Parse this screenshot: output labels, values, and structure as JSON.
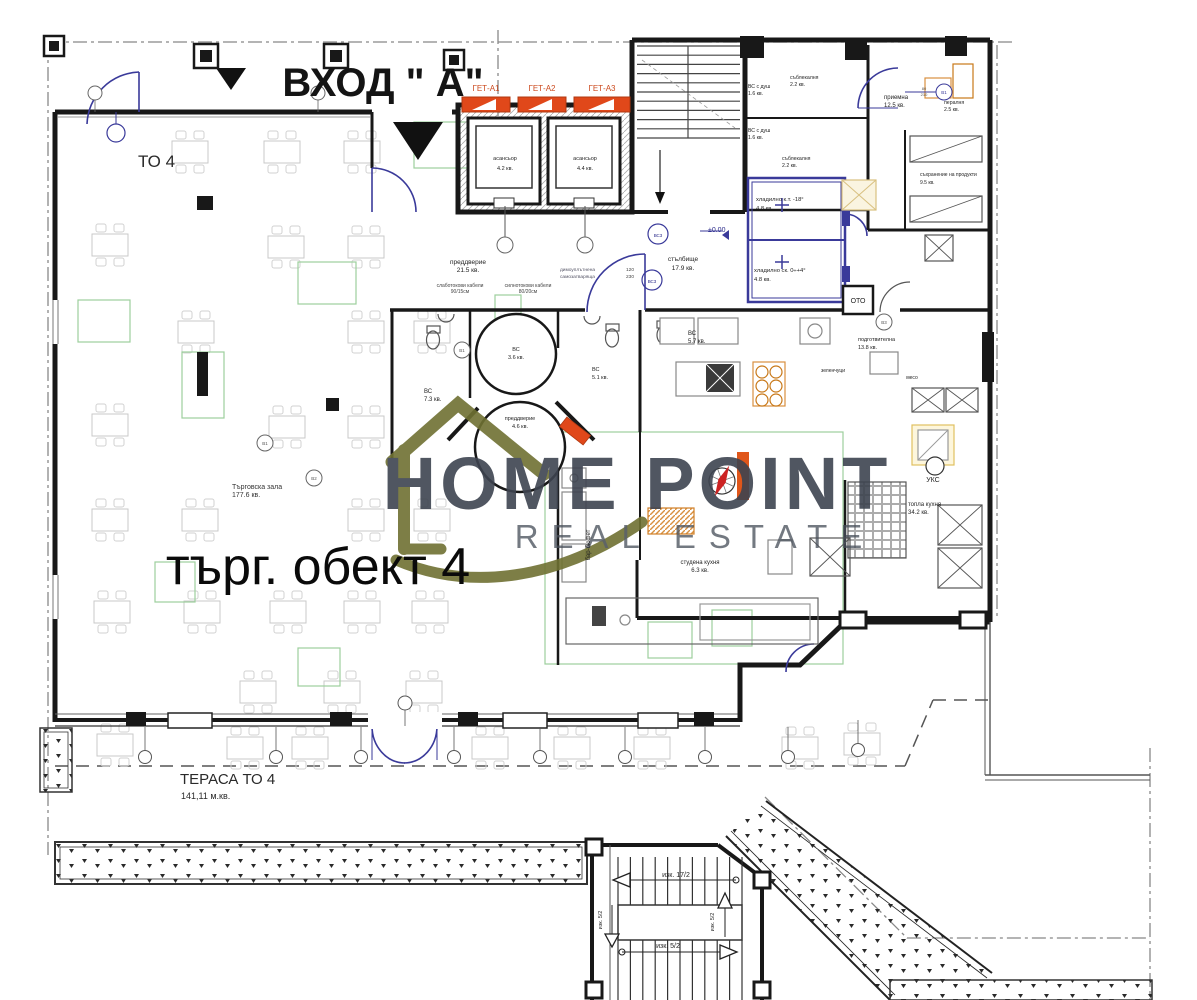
{
  "title": "Floor plan – търговски обект 4, вход А",
  "watermark": {
    "brand_line1": "HOME POINT",
    "brand_line2": "REAL ESTATE",
    "text_color": "#3e4450",
    "logo_color": "#6f7132"
  },
  "colors": {
    "wall": "#181818",
    "blue": "#3a3a9a",
    "green": "#9ccf9c",
    "gate_red": "#e0481a",
    "amber": "#d89040",
    "faint": "#c9c9c9"
  },
  "labels": [
    {
      "id": "entrance",
      "t": "ВХОД \" А\"",
      "x": 383,
      "y": 96,
      "s": 40,
      "w": "600",
      "a": "middle",
      "c": "#141414"
    },
    {
      "id": "to4",
      "t": "ТО 4",
      "x": 138,
      "y": 167,
      "s": 17,
      "a": "start",
      "c": "#2a2a2a"
    },
    {
      "id": "unit",
      "t": "търг. обект 4",
      "x": 318,
      "y": 584,
      "s": 52,
      "a": "middle",
      "c": "#0a0a0a"
    },
    {
      "id": "hall-name",
      "t": "Търговска зала",
      "x": 232,
      "y": 489,
      "s": 7,
      "a": "start",
      "c": "#333333"
    },
    {
      "id": "hall-area",
      "t": "177.6 кв.",
      "x": 232,
      "y": 497,
      "s": 7,
      "a": "start",
      "c": "#333333"
    },
    {
      "id": "terrace-name",
      "t": "ТЕРАСА ТО 4",
      "x": 180,
      "y": 784,
      "s": 15,
      "a": "start",
      "c": "#2a2a2a"
    },
    {
      "id": "terrace-area",
      "t": "141,11 м.кв.",
      "x": 181,
      "y": 799,
      "s": 9,
      "a": "start",
      "c": "#2a2a2a"
    },
    {
      "id": "vest215-name",
      "t": "преддверие",
      "x": 468,
      "y": 264,
      "s": 6.5,
      "a": "middle"
    },
    {
      "id": "vest215-area",
      "t": "21.5 кв.",
      "x": 468,
      "y": 272,
      "s": 6.5,
      "a": "middle"
    },
    {
      "id": "cab1a",
      "t": "слаботокови кабели",
      "x": 460,
      "y": 287,
      "s": 5,
      "a": "middle",
      "c": "#444444"
    },
    {
      "id": "cab1b",
      "t": "90/15см",
      "x": 460,
      "y": 293,
      "s": 5,
      "a": "middle",
      "c": "#444444"
    },
    {
      "id": "cab2a",
      "t": "силнотокови кабели",
      "x": 528,
      "y": 287,
      "s": 5,
      "a": "middle",
      "c": "#444444"
    },
    {
      "id": "cab2b",
      "t": "80/20см",
      "x": 528,
      "y": 293,
      "s": 5,
      "a": "middle",
      "c": "#444444"
    },
    {
      "id": "lift1-name",
      "t": "асансьор",
      "x": 505,
      "y": 160,
      "s": 5.5,
      "a": "middle"
    },
    {
      "id": "lift1-area",
      "t": "4.2 кв.",
      "x": 505,
      "y": 170,
      "s": 5.5,
      "a": "middle"
    },
    {
      "id": "lift2-name",
      "t": "асансьор",
      "x": 585,
      "y": 160,
      "s": 5.5,
      "a": "middle"
    },
    {
      "id": "lift2-area",
      "t": "4.4 кв.",
      "x": 585,
      "y": 170,
      "s": 5.5,
      "a": "middle"
    },
    {
      "id": "get1",
      "t": "ГЕТ-А1",
      "x": 486,
      "y": 91,
      "s": 8,
      "a": "middle",
      "c": "#cc4a1e"
    },
    {
      "id": "get2",
      "t": "ГЕТ-А2",
      "x": 542,
      "y": 91,
      "s": 8,
      "a": "middle",
      "c": "#cc4a1e"
    },
    {
      "id": "get3",
      "t": "ГЕТ-А3",
      "x": 602,
      "y": 91,
      "s": 8,
      "a": "middle",
      "c": "#cc4a1e"
    },
    {
      "id": "stair-name",
      "t": "стълбище",
      "x": 683,
      "y": 261,
      "s": 6.5,
      "a": "middle"
    },
    {
      "id": "stair-area",
      "t": "17.9 кв.",
      "x": 683,
      "y": 270,
      "s": 6.5,
      "a": "middle"
    },
    {
      "id": "level",
      "t": "±0.00",
      "x": 708,
      "y": 232,
      "s": 7,
      "a": "start",
      "c": "#2a2a8a"
    },
    {
      "id": "cold1-name",
      "t": "хладилно к.т. -18°",
      "x": 756,
      "y": 201,
      "s": 5.8,
      "a": "start"
    },
    {
      "id": "cold1-area",
      "t": "4.8 кв.",
      "x": 756,
      "y": 210,
      "s": 5.8,
      "a": "start"
    },
    {
      "id": "cold2-name",
      "t": "хладилно ск. 0÷+4°",
      "x": 754,
      "y": 272,
      "s": 5.8,
      "a": "start"
    },
    {
      "id": "cold2-area",
      "t": "4.8 кв.",
      "x": 754,
      "y": 281,
      "s": 5.8,
      "a": "start"
    },
    {
      "id": "shower1-name",
      "t": "ВС с душ",
      "x": 748,
      "y": 88,
      "s": 5.2,
      "a": "start"
    },
    {
      "id": "shower1-area",
      "t": "1.6 кв.",
      "x": 748,
      "y": 95,
      "s": 5.2,
      "a": "start"
    },
    {
      "id": "shower2-name",
      "t": "ВС с душ",
      "x": 748,
      "y": 132,
      "s": 5.2,
      "a": "start"
    },
    {
      "id": "shower2-area",
      "t": "1.6 кв.",
      "x": 748,
      "y": 139,
      "s": 5.2,
      "a": "start"
    },
    {
      "id": "dress1-name",
      "t": "съблекалня",
      "x": 790,
      "y": 79,
      "s": 5.2,
      "a": "start"
    },
    {
      "id": "dress1-area",
      "t": "2.2 кв.",
      "x": 790,
      "y": 86,
      "s": 5.2,
      "a": "start"
    },
    {
      "id": "dress2-name",
      "t": "съблекалня",
      "x": 782,
      "y": 160,
      "s": 5.2,
      "a": "start"
    },
    {
      "id": "dress2-area",
      "t": "2.2 кв.",
      "x": 782,
      "y": 167,
      "s": 5.2,
      "a": "start"
    },
    {
      "id": "recep-name",
      "t": "приемна",
      "x": 884,
      "y": 99,
      "s": 6,
      "a": "start"
    },
    {
      "id": "recep-area",
      "t": "12.5 кв.",
      "x": 884,
      "y": 107,
      "s": 6,
      "a": "start"
    },
    {
      "id": "laundry-name",
      "t": "пералня",
      "x": 944,
      "y": 104,
      "s": 5.2,
      "a": "start"
    },
    {
      "id": "laundry-area",
      "t": "2.5 кв.",
      "x": 944,
      "y": 111,
      "s": 5.2,
      "a": "start"
    },
    {
      "id": "store-name",
      "t": "съхранение на продукти",
      "x": 920,
      "y": 176,
      "s": 5,
      "a": "start"
    },
    {
      "id": "store-area",
      "t": "9.5 кв.",
      "x": 920,
      "y": 184,
      "s": 5,
      "a": "start"
    },
    {
      "id": "wc57-name",
      "t": "ВС",
      "x": 688,
      "y": 335,
      "s": 6,
      "a": "start"
    },
    {
      "id": "wc57-area",
      "t": "5.7 кв.",
      "x": 688,
      "y": 343,
      "s": 6,
      "a": "start"
    },
    {
      "id": "prep-name",
      "t": "подготвителна",
      "x": 858,
      "y": 341,
      "s": 5.5,
      "a": "start"
    },
    {
      "id": "prep-area",
      "t": "13.8 кв.",
      "x": 858,
      "y": 349,
      "s": 5.5,
      "a": "start"
    },
    {
      "id": "veg",
      "t": "зеленчуци",
      "x": 833,
      "y": 372,
      "s": 5,
      "a": "middle"
    },
    {
      "id": "meat",
      "t": "месо",
      "x": 912,
      "y": 379,
      "s": 5,
      "a": "middle"
    },
    {
      "id": "hot-name",
      "t": "топла кухня",
      "x": 908,
      "y": 506,
      "s": 6,
      "a": "start"
    },
    {
      "id": "hot-area",
      "t": "34.2 кв.",
      "x": 908,
      "y": 514,
      "s": 6,
      "a": "start"
    },
    {
      "id": "coldk-name",
      "t": "студена кухня",
      "x": 700,
      "y": 564,
      "s": 6,
      "a": "middle"
    },
    {
      "id": "coldk-area",
      "t": "6.3 кв.",
      "x": 700,
      "y": 572,
      "s": 6,
      "a": "middle"
    },
    {
      "id": "bar",
      "t": "бар-бюфет",
      "x": 590,
      "y": 545,
      "s": 6,
      "a": "middle",
      "r": -90
    },
    {
      "id": "uks",
      "t": "УКС",
      "x": 933,
      "y": 482,
      "s": 7,
      "a": "middle"
    },
    {
      "id": "oto",
      "t": "ОТО",
      "x": 858,
      "y": 303,
      "s": 7,
      "a": "middle"
    },
    {
      "id": "wc73-name",
      "t": "ВС",
      "x": 424,
      "y": 393,
      "s": 6,
      "a": "start"
    },
    {
      "id": "wc73-area",
      "t": "7.3 кв.",
      "x": 424,
      "y": 401,
      "s": 6,
      "a": "start"
    },
    {
      "id": "wc36-name",
      "t": "ВС",
      "x": 516,
      "y": 351,
      "s": 5.5,
      "a": "middle"
    },
    {
      "id": "wc36-area",
      "t": "3.6 кв.",
      "x": 516,
      "y": 359,
      "s": 5.5,
      "a": "middle"
    },
    {
      "id": "vest46-name",
      "t": "преддверие",
      "x": 520,
      "y": 420,
      "s": 5.5,
      "a": "middle"
    },
    {
      "id": "vest46-area",
      "t": "4.6 кв.",
      "x": 520,
      "y": 428,
      "s": 5.5,
      "a": "middle"
    },
    {
      "id": "wc51-name",
      "t": "ВС",
      "x": 592,
      "y": 371,
      "s": 5.5,
      "a": "start"
    },
    {
      "id": "wc51-area",
      "t": "5.1 кв.",
      "x": 592,
      "y": 379,
      "s": 5.5,
      "a": "start"
    },
    {
      "id": "smoke1",
      "t": "димоуплътнена",
      "x": 560,
      "y": 271,
      "s": 4.8,
      "a": "start",
      "c": "#555566"
    },
    {
      "id": "smoke2",
      "t": "самозатваряща",
      "x": 560,
      "y": 278,
      "s": 4.8,
      "a": "start",
      "c": "#555566"
    },
    {
      "id": "d1",
      "t": "120",
      "x": 626,
      "y": 271,
      "s": 4.8,
      "a": "start",
      "c": "#444444"
    },
    {
      "id": "d2",
      "t": "230",
      "x": 626,
      "y": 278,
      "s": 4.8,
      "a": "start",
      "c": "#444444"
    },
    {
      "id": "bs3a",
      "t": "ВС3",
      "x": 658,
      "y": 237,
      "s": 4.5,
      "a": "middle",
      "c": "#2a2a8a"
    },
    {
      "id": "bs3b",
      "t": "ВС3",
      "x": 652,
      "y": 283,
      "s": 4.5,
      "a": "middle",
      "c": "#2a2a8a"
    },
    {
      "id": "st1",
      "t": "изк. 17/2",
      "x": 676,
      "y": 877,
      "s": 7,
      "a": "middle"
    },
    {
      "id": "st2",
      "t": "изк. 5/2",
      "x": 668,
      "y": 948,
      "s": 7,
      "a": "middle"
    },
    {
      "id": "st3",
      "t": "изк. 5/2",
      "x": 714,
      "y": 922,
      "s": 5.5,
      "a": "middle",
      "r": -90
    },
    {
      "id": "st4",
      "t": "изк. 5/2",
      "x": 602,
      "y": 920,
      "s": 5.5,
      "a": "middle",
      "r": -90
    },
    {
      "id": "tag1",
      "t": "В1",
      "x": 265,
      "y": 445,
      "s": 4.5,
      "a": "middle",
      "c": "#555555"
    },
    {
      "id": "tag2",
      "t": "В2",
      "x": 314,
      "y": 480,
      "s": 4.5,
      "a": "middle",
      "c": "#555555"
    },
    {
      "id": "tag3",
      "t": "В1",
      "x": 462,
      "y": 352,
      "s": 4.5,
      "a": "middle",
      "c": "#555555"
    },
    {
      "id": "tag4",
      "t": "В1",
      "x": 944,
      "y": 94,
      "s": 4.5,
      "a": "middle",
      "c": "#3a3a9a"
    },
    {
      "id": "dim4a",
      "t": "80",
      "x": 924,
      "y": 90,
      "s": 4,
      "a": "middle",
      "c": "#555555"
    },
    {
      "id": "dim4b",
      "t": "210",
      "x": 924,
      "y": 96,
      "s": 4,
      "a": "middle",
      "c": "#555555"
    },
    {
      "id": "tag5",
      "t": "В3",
      "x": 884,
      "y": 324,
      "s": 4.5,
      "a": "middle",
      "c": "#555555"
    }
  ]
}
